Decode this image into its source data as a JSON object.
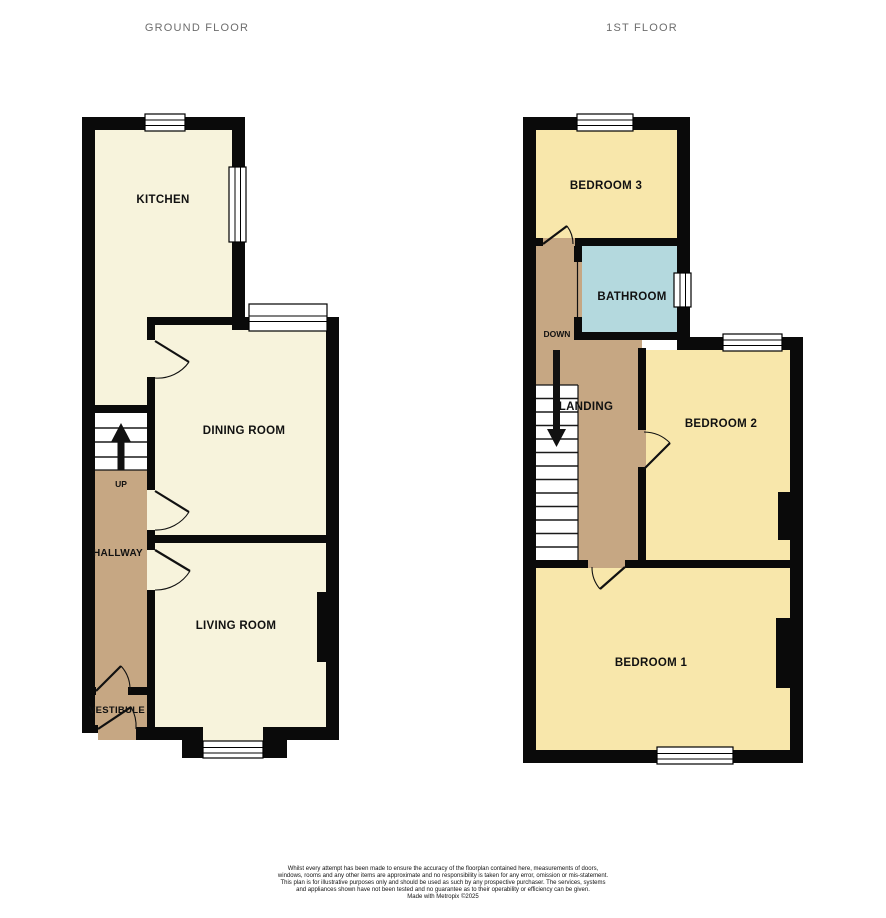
{
  "colors": {
    "wall": "#0a0a0a",
    "cream": "#f7f3dc",
    "yellow": "#f8e7ab",
    "tan": "#c6a783",
    "blue": "#b4d9de",
    "stairs_white": "#ffffff"
  },
  "ground_floor": {
    "title": "GROUND FLOOR",
    "rooms": {
      "kitchen": "KITCHEN",
      "dining": "DINING ROOM",
      "living": "LIVING ROOM",
      "hallway": "HALLWAY",
      "vestibule": "VESTIBULE"
    },
    "stairs": {
      "label": "UP"
    }
  },
  "first_floor": {
    "title": "1ST FLOOR",
    "rooms": {
      "bedroom3": "BEDROOM 3",
      "bathroom": "BATHROOM",
      "landing": "LANDING",
      "bedroom2": "BEDROOM 2",
      "bedroom1": "BEDROOM 1"
    },
    "stairs": {
      "label": "DOWN"
    }
  },
  "footer": {
    "disclaimer": "Whilst every attempt has been made to ensure the accuracy of the floorplan contained here, measurements of doors, windows, rooms and any other items are approximate and no responsibility is taken for any error, omission or mis-statement. This plan is for illustrative purposes only and should be used as such by any prospective purchaser. The services, systems and appliances shown have not been tested and no guarantee as to their operability or efficiency can be given.",
    "credit": "Made with Metropix ©2025"
  }
}
